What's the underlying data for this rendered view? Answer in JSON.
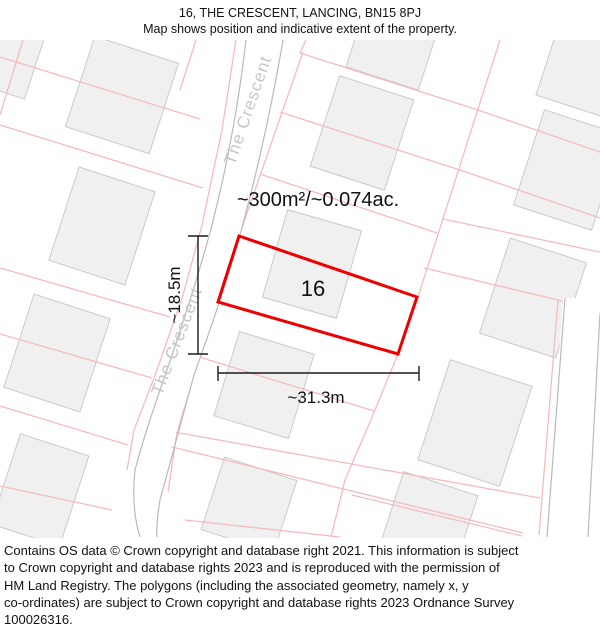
{
  "header": {
    "title": "16, THE CRESCENT, LANCING, BN15 8PJ",
    "subtitle": "Map shows position and indicative extent of the property."
  },
  "map": {
    "area_label": "~300m²/~0.074ac.",
    "plot_number": "16",
    "width_label": "~31.3m",
    "height_label": "~18.5m",
    "road_label_top": "The Crescent",
    "road_label_bottom": "The Crescent",
    "colors": {
      "property_outline": "#ee0000",
      "parcel_line": "#f5bcbc",
      "building_fill": "#f0f0f0",
      "building_stroke": "#cacaca",
      "road_edge": "#b9b9b9",
      "road_label": "#c6c6c6",
      "dimension_line": "#1a1a1a",
      "text": "#111111"
    }
  },
  "footer": {
    "lines": [
      "Contains OS data © Crown copyright and database right 2021. This information is subject",
      "to Crown copyright and database rights 2023 and is reproduced with the permission of",
      "HM Land Registry. The polygons (including the associated geometry, namely x, y",
      "co-ordinates) are subject to Crown copyright and database rights 2023 Ordnance Survey",
      "100026316."
    ]
  }
}
